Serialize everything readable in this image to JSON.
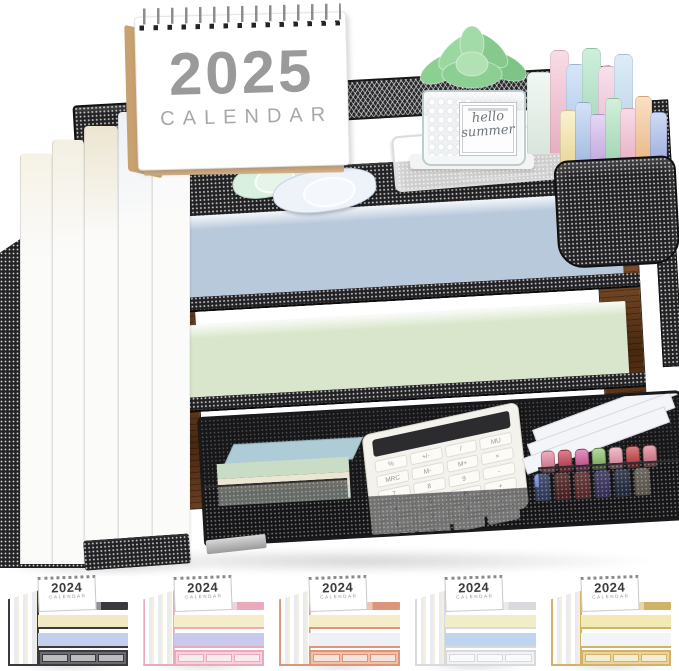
{
  "scene": {
    "calendar": {
      "year": "2025",
      "label": "CALENDAR"
    },
    "plant_sign": {
      "line1": "hello",
      "line2": "summer"
    },
    "colors": {
      "mesh_black": "#1c1c1e",
      "wood_brown": "#6b3d22",
      "tray_paper_blue": "#b9c9dc",
      "tray_paper_mint": "#d9e6cb",
      "calendar_stand_kraft": "#c8a171",
      "succulent_green": "#85c98c"
    },
    "notebooks": [
      "#f6f2e6",
      "#f3efe2",
      "#ece5d0",
      "#edf0f6",
      "#f7f8fb"
    ],
    "highlighters_back": [
      "#e4f1e8",
      "#f2b9cc",
      "#aecdf2",
      "#9fdfba",
      "#f0c0d8",
      "#bcd9f0"
    ],
    "highlighters_cup": [
      "#f5e3a0",
      "#a8c3ef",
      "#c9aee8",
      "#a5e0b8",
      "#f2b8cf",
      "#f5c089",
      "#9fb4e8"
    ],
    "sticky_notes": {
      "top": "#aeccd6",
      "front": [
        "#c9dcc5",
        "#ebe6d1",
        "#d6e2d8"
      ]
    },
    "markers_back": [
      "#e8829e",
      "#cc3b4e",
      "#d9569b",
      "#8bc46a",
      "#ef9ab0",
      "#c93b3b",
      "#e07a8a"
    ],
    "markers_front": [
      "#5a79d6",
      "#a83232",
      "#d04545",
      "#6a5acd",
      "#31477f",
      "#d9c9a8"
    ],
    "calculator_keys": [
      "%",
      "+/-",
      "/",
      "MU",
      "MRC",
      "M-",
      "M+",
      "×",
      "7",
      "8",
      "9",
      "-",
      "4",
      "5",
      "6",
      "+",
      "1",
      "2",
      "3",
      "=",
      "0",
      "00",
      ".",
      ""
    ]
  },
  "thumbnails": [
    {
      "year": "2024",
      "label": "CALENDAR",
      "variant": "black",
      "frame": "#3a3a3e",
      "frame_light": "#6a6a70",
      "paper1": "#f1e9c4",
      "paper2": "#c3cfec"
    },
    {
      "year": "2024",
      "label": "CALENDAR",
      "variant": "pink",
      "frame": "#e9aabc",
      "frame_light": "#f5d2dc",
      "paper1": "#f5ecca",
      "paper2": "#c9c9ee"
    },
    {
      "year": "2024",
      "label": "CALENDAR",
      "variant": "rose-gold",
      "frame": "#dd9579",
      "frame_light": "#efc0aa",
      "paper1": "#f5ecca",
      "paper2": "#eef0f5"
    },
    {
      "year": "2024",
      "label": "CALENDAR",
      "variant": "white",
      "frame": "#d8dade",
      "frame_light": "#f2f3f6",
      "paper1": "#f0eec6",
      "paper2": "#bfd4ee"
    },
    {
      "year": "2024",
      "label": "CALENDAR",
      "variant": "gold",
      "frame": "#d2b268",
      "frame_light": "#e9d49c",
      "paper1": "#f2e9b4",
      "paper2": "#f3f4f6"
    }
  ]
}
